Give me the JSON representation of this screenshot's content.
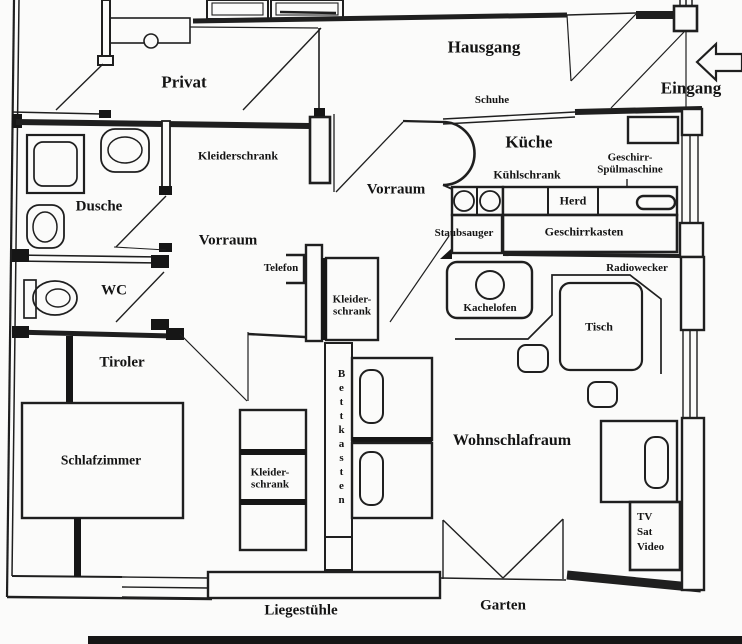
{
  "colors": {
    "background": "#fbfbfa",
    "ink": "#1f1f1f"
  },
  "rooms": {
    "privat": "Privat",
    "hausgang": "Hausgang",
    "eingang": "Eingang",
    "kueche": "Küche",
    "vorraum_oben": "Vorraum",
    "vorraum_unten": "Vorraum",
    "dusche": "Dusche",
    "wc": "WC",
    "tiroler": "Tiroler",
    "schlafzimmer": "Schlafzimmer",
    "wohnschlafraum": "Wohnschlafraum",
    "garten": "Garten"
  },
  "fixtures": {
    "schuhe": "Schuhe",
    "kleiderschrank_oben": "Kleiderschrank",
    "kuehlschrank": "Kühlschrank",
    "geschirrspueler_line1": "Geschirr-",
    "geschirrspueler_line2": "Spülmaschine",
    "herd": "Herd",
    "staubsauger": "Staubsauger",
    "geschirrkasten": "Geschirrkasten",
    "telefon": "Telefon",
    "radiowecker": "Radiowecker",
    "kleiderschrank_mitte_line1": "Kleider-",
    "kleiderschrank_mitte_line2": "schrank",
    "kachelofen": "Kachelofen",
    "tisch": "Tisch",
    "bettkasten": "Bettkasten",
    "kleiderschrank_unten_line1": "Kleider-",
    "kleiderschrank_unten_line2": "schrank",
    "tv_line1": "TV",
    "tv_line2": "Sat",
    "tv_line3": "Video",
    "liegestuehle": "Liegestühle"
  }
}
